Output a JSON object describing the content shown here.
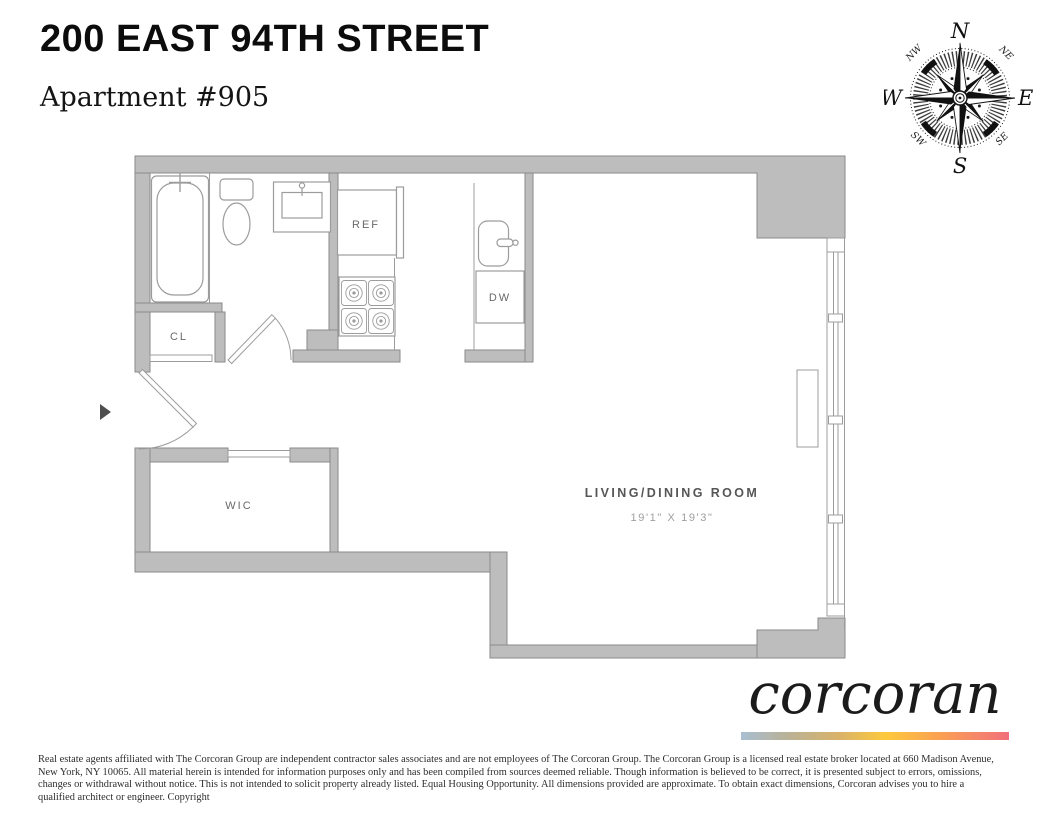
{
  "header": {
    "address": "200 EAST 94TH STREET",
    "apartment": "Apartment #905"
  },
  "compass": {
    "n": "N",
    "e": "E",
    "s": "S",
    "w": "W",
    "nw": "NW",
    "ne": "NE",
    "sw": "SW",
    "se": "SE"
  },
  "floorplan": {
    "labels": {
      "refrigerator": "REF",
      "dishwasher": "DW",
      "closet": "CL",
      "walk_in_closet": "WIC",
      "living_room": "LIVING/DINING ROOM",
      "living_room_dimensions": "19'1\" X 19'3\""
    }
  },
  "footer": {
    "logo": "corcoran",
    "disclaimer_lines": [
      "Real estate agents affiliated with The Corcoran Group are independent contractor sales associates and are not employees of The Corcoran Group. The Corcoran Group is a licensed real estate broker located at 660 Madison Avenue,",
      "New York, NY 10065. All material herein is intended for information purposes only and has been compiled from sources deemed reliable. Though information is believed to be correct, it is presented subject to errors, omissions,",
      "changes or withdrawal without notice. This is not intended to solicit property already listed. Equal Housing Opportunity. All dimensions provided are approximate. To obtain exact dimensions, Corcoran advises you to hire a",
      "qualified architect or engineer. Copyright"
    ]
  },
  "colors": {
    "wall_fill": "#bdbdbd",
    "wall_stroke": "#8a8a8a",
    "fixture_stroke": "#9c9c9c",
    "room_label_text": "#696969",
    "dimension_text": "#9f9f9f",
    "title_text": "#0c0c0c",
    "brand_gradient": [
      "#a9bfd2",
      "#b7b29a",
      "#d8b26b",
      "#fdc93c",
      "#f99d55",
      "#f2707b"
    ]
  }
}
